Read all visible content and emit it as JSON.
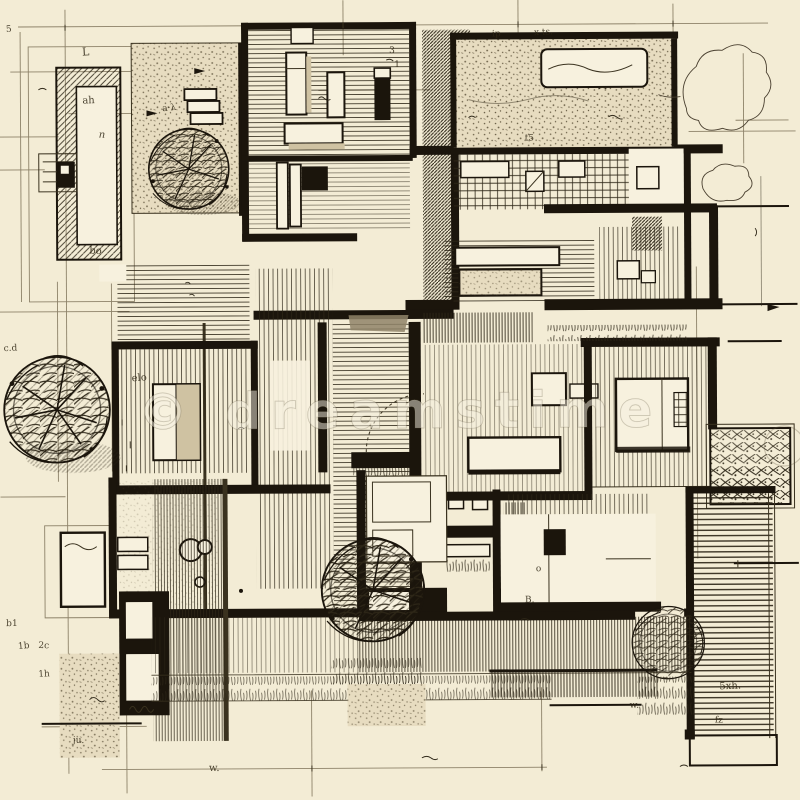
{
  "meta": {
    "alt": "Hand-drawn architectural floor plan sketch, black ink on cream paper, with hatched rooms, trees, pool, decks and dimension lines"
  },
  "watermark": {
    "text": "© dreamstime"
  },
  "colors": {
    "paper": "#f3ecd5",
    "paper_light": "#f7f1de",
    "ink": "#1b150c",
    "ink_light": "#3a321f",
    "hatch": "#2e2718",
    "pencil": "#8d8269",
    "wash_grey": "#8f8468",
    "wash_tan": "#cfc2a2",
    "stipple_bg": "#e7dcc0",
    "watermark_tone": "#8a7d60"
  },
  "annotations": [
    {
      "text": "5",
      "x": 8,
      "y": 30,
      "s": 9,
      "r": -4
    },
    {
      "text": "L",
      "x": 84,
      "y": 54,
      "s": 11,
      "r": -3
    },
    {
      "text": "ah",
      "x": 84,
      "y": 102,
      "s": 10,
      "r": -2
    },
    {
      "text": "n",
      "x": 100,
      "y": 136,
      "s": 10,
      "r": 3,
      "i": true
    },
    {
      "text": "bo",
      "x": 90,
      "y": 252,
      "s": 10,
      "r": 2
    },
    {
      "text": "a·λ",
      "x": 164,
      "y": 110,
      "s": 9,
      "r": -6
    },
    {
      "text": "ip",
      "x": 494,
      "y": 37,
      "s": 9,
      "r": -2
    },
    {
      "text": "x ts.",
      "x": 536,
      "y": 36,
      "s": 9,
      "r": -3
    },
    {
      "text": "t5",
      "x": 526,
      "y": 141,
      "s": 9,
      "r": 2
    },
    {
      "text": "3",
      "x": 391,
      "y": 53,
      "s": 9,
      "r": 0
    },
    {
      "text": "1",
      "x": 396,
      "y": 67,
      "s": 9,
      "r": 0
    },
    {
      "text": "elo",
      "x": 132,
      "y": 380,
      "s": 10,
      "r": -4
    },
    {
      "text": "c.d",
      "x": 4,
      "y": 349,
      "s": 9,
      "r": -2
    },
    {
      "text": "b1",
      "x": 5,
      "y": 624,
      "s": 9,
      "r": 0
    },
    {
      "text": "1b",
      "x": 17,
      "y": 647,
      "s": 9,
      "r": -5
    },
    {
      "text": "2c",
      "x": 37,
      "y": 646,
      "s": 9,
      "r": 3
    },
    {
      "text": "1h",
      "x": 37,
      "y": 675,
      "s": 9,
      "r": -3
    },
    {
      "text": "ju.",
      "x": 71,
      "y": 741,
      "s": 9,
      "r": 2
    },
    {
      "text": "w.",
      "x": 207,
      "y": 770,
      "s": 10,
      "r": 0
    },
    {
      "text": "o",
      "x": 535,
      "y": 572,
      "s": 9,
      "r": 0
    },
    {
      "text": "B.",
      "x": 524,
      "y": 603,
      "s": 9,
      "r": 0
    },
    {
      "text": "w.",
      "x": 628,
      "y": 709,
      "s": 9,
      "r": 0
    },
    {
      "text": "5xh.",
      "x": 718,
      "y": 691,
      "s": 10,
      "r": -2
    },
    {
      "text": "fz",
      "x": 713,
      "y": 724,
      "s": 9,
      "r": 4
    }
  ]
}
